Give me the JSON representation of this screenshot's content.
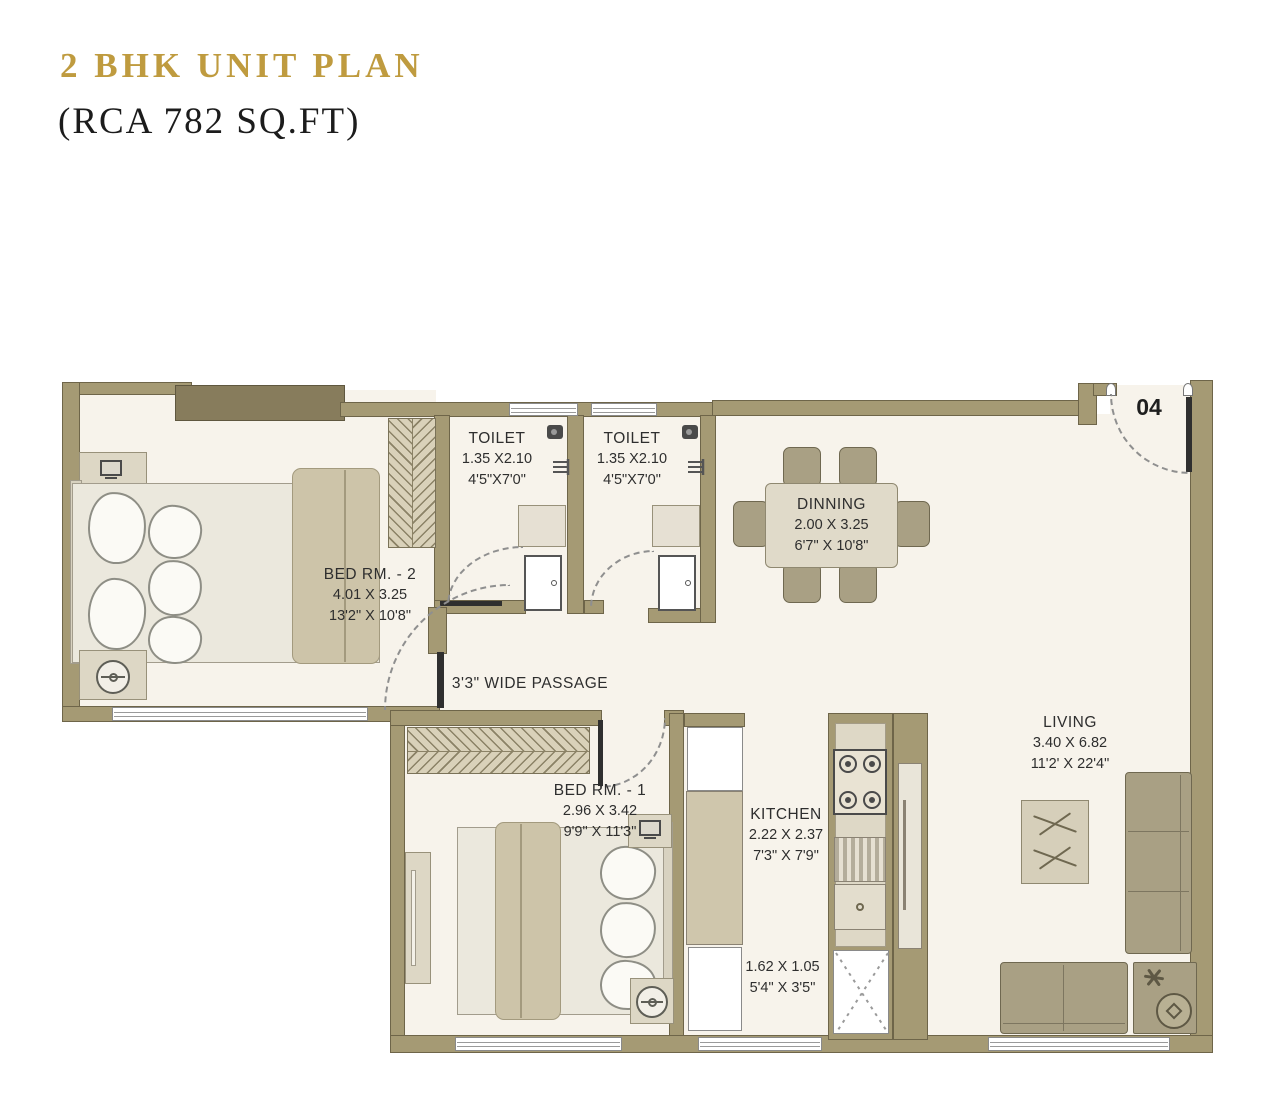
{
  "header": {
    "title": "2 BHK UNIT PLAN",
    "subtitle": "(RCA 782 SQ.FT)"
  },
  "unit_number": "04",
  "rooms": {
    "toilet1": {
      "name": "TOILET",
      "metric": "1.35 X2.10",
      "imperial": "4'5\"X7'0\""
    },
    "toilet2": {
      "name": "TOILET",
      "metric": "1.35 X2.10",
      "imperial": "4'5\"X7'0\""
    },
    "dinning": {
      "name": "DINNING",
      "metric": "2.00 X 3.25",
      "imperial": "6'7\" X 10'8\""
    },
    "bed2": {
      "name": "BED RM. - 2",
      "metric": "4.01 X 3.25",
      "imperial": "13'2\" X 10'8\""
    },
    "passage": {
      "name": "3'3\" WIDE PASSAGE"
    },
    "bed1": {
      "name": "BED RM. - 1",
      "metric": "2.96 X 3.42",
      "imperial": "9'9\" X 11'3\""
    },
    "kitchen": {
      "name": "KITCHEN",
      "metric": "2.22 X 2.37",
      "imperial": "7'3\" X 7'9\""
    },
    "living": {
      "name": "LIVING",
      "metric": "3.40 X 6.82",
      "imperial": "11'2' X 22'4\""
    },
    "utility": {
      "metric": "1.62 X 1.05",
      "imperial": "5'4\" X 3'5\""
    }
  },
  "palette": {
    "title_gold": "#bf9b3f",
    "wall": "#a59a74",
    "wall_dark": "#877c5c",
    "floor": "#f7f3eb",
    "furniture": "#a9a084",
    "furniture_light": "#ddd7c5"
  }
}
